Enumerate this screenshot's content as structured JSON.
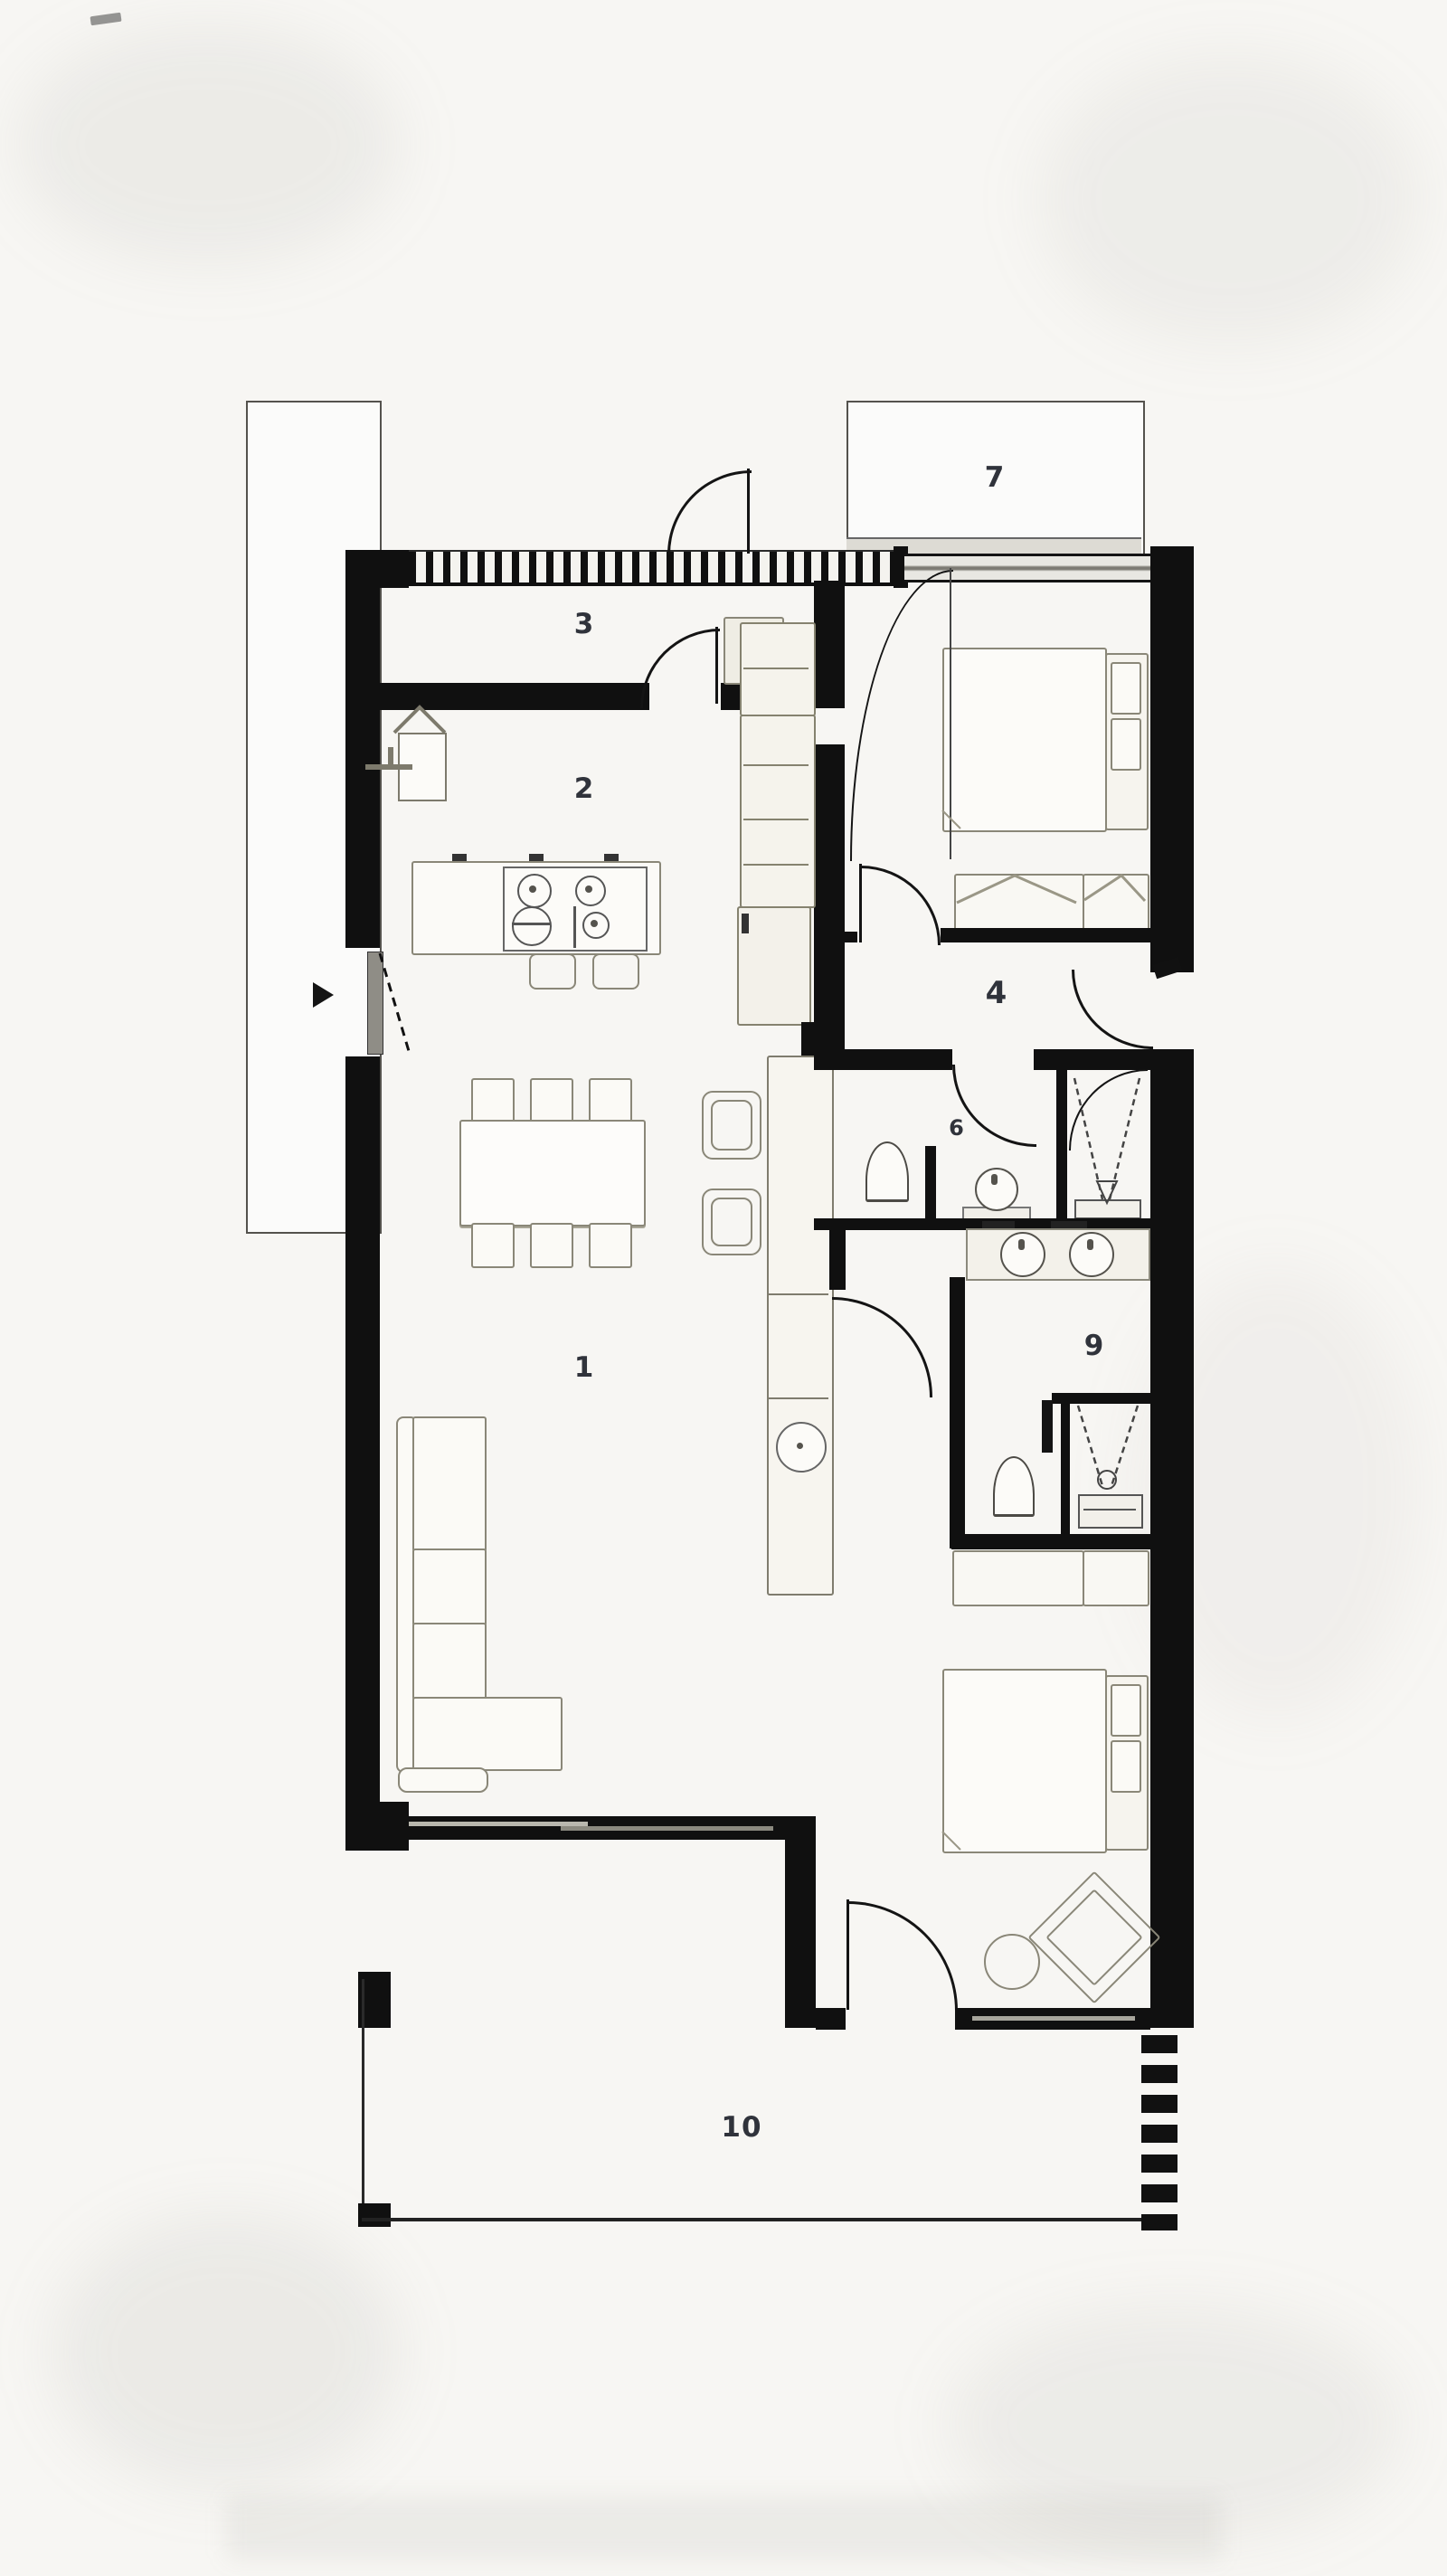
{
  "labels": {
    "living": "1",
    "kitchen": "2",
    "entry": "3",
    "hallway": "4",
    "bedroom_upper": "5",
    "bathroom": "6",
    "balcony": "7",
    "bedroom_lower": "6",
    "dressing": "9",
    "terrace": "10"
  },
  "colors": {
    "wall": "#101010",
    "background": "#f7f6f3",
    "furniture_stroke": "#8a8778",
    "sanitary_stroke": "#4c4a45",
    "label_text": "#30333b"
  },
  "fixtures": [
    "entry-door-icon",
    "dining-table-icon",
    "dining-chair-icon",
    "armchair-icon",
    "sectional-sofa-icon",
    "kitchen-island-icon",
    "cooktop-icon",
    "bar-stool-icon",
    "corner-sink-icon",
    "tall-cabinet-icon",
    "sideboard-icon",
    "double-bed-icon",
    "bed-bench-icon",
    "dresser-icon",
    "toilet-icon",
    "shower-icon",
    "washbasin-icon",
    "double-vanity-icon",
    "lounge-chair-icon",
    "side-table-icon",
    "terrace-screen-icon",
    "entry-arrow-icon"
  ]
}
